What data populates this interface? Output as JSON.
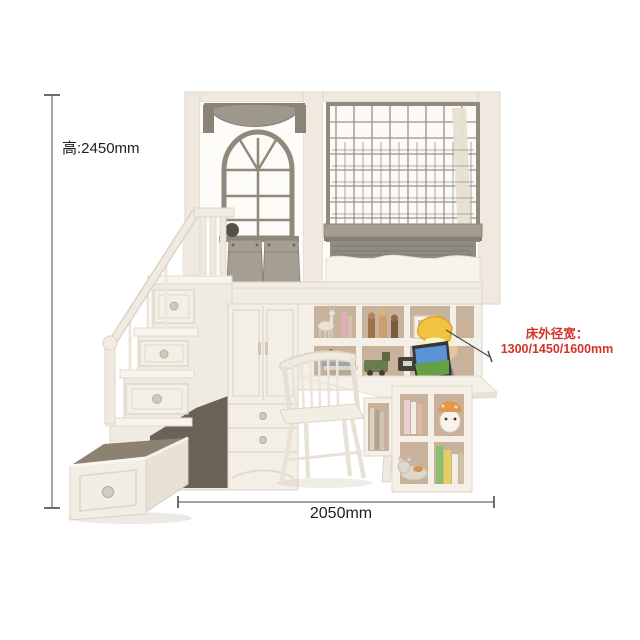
{
  "annotations": {
    "height_label": "高:2450mm",
    "width_label": "2050mm",
    "bed_width_title": "床外径宽：",
    "bed_width_values": "1300/1450/1600mm"
  },
  "colors": {
    "annotation_red": "#d2342a",
    "dimension_line": "#6a6a6a",
    "furniture_cream": "#f1ece3",
    "frame_gray": "#8f887b",
    "fabric_gray": "#a19a8f",
    "cubby_tan": "#c9b29b",
    "lamp_yellow": "#f2c340",
    "laptop_screen_sky": "#5b93d8",
    "laptop_screen_grass": "#63a144"
  }
}
